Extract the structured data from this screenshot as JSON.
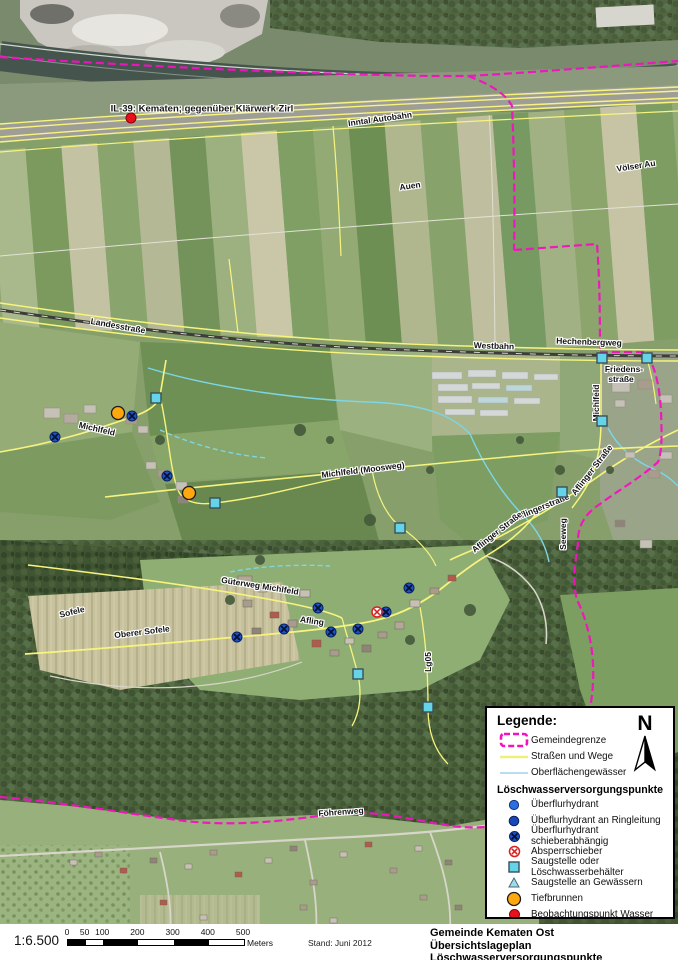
{
  "map": {
    "labels": [
      {
        "text": "IL-39: Kematen; gegenüber Klärwerk Zirl",
        "x": 202,
        "y": 109,
        "rot": 0,
        "cls": "callout"
      },
      {
        "text": "Inntal Autobahn",
        "x": 380,
        "y": 119,
        "rot": -8
      },
      {
        "text": "Auen",
        "x": 410,
        "y": 186,
        "rot": -8
      },
      {
        "text": "Völser Au",
        "x": 636,
        "y": 166,
        "rot": -9
      },
      {
        "text": "Landesstraße",
        "x": 118,
        "y": 326,
        "rot": 10
      },
      {
        "text": "Westbahn",
        "x": 494,
        "y": 346,
        "rot": 2
      },
      {
        "text": "Hechenbergweg",
        "x": 589,
        "y": 342,
        "rot": 2
      },
      {
        "text": "Friedens-",
        "x": 624,
        "y": 369,
        "rot": 0
      },
      {
        "text": "straße",
        "x": 621,
        "y": 379,
        "rot": 0
      },
      {
        "text": "Michlfeld",
        "x": 596,
        "y": 403,
        "rot": -90
      },
      {
        "text": "Michlfeld",
        "x": 97,
        "y": 429,
        "rot": 13
      },
      {
        "text": "Michlfeld (Moosweg)",
        "x": 363,
        "y": 470,
        "rot": -7
      },
      {
        "text": "Aflinger Straße",
        "x": 592,
        "y": 470,
        "rot": -52
      },
      {
        "text": "Aflingerstraße",
        "x": 542,
        "y": 507,
        "rot": -22
      },
      {
        "text": "Aflinger Straße",
        "x": 497,
        "y": 532,
        "rot": -38
      },
      {
        "text": "Seeweg",
        "x": 563,
        "y": 534,
        "rot": -90
      },
      {
        "text": "Güterweg Michlfeld",
        "x": 260,
        "y": 586,
        "rot": 9
      },
      {
        "text": "Afling",
        "x": 312,
        "y": 621,
        "rot": 8
      },
      {
        "text": "Sofele",
        "x": 72,
        "y": 612,
        "rot": -14
      },
      {
        "text": "Oberer Sofele",
        "x": 142,
        "y": 632,
        "rot": -7
      },
      {
        "text": "Lg05",
        "x": 428,
        "y": 662,
        "rot": -90
      },
      {
        "text": "Föhrenweg",
        "x": 341,
        "y": 812,
        "rot": -4
      }
    ],
    "symbols": [
      {
        "type": "obs",
        "x": 131,
        "y": 118
      },
      {
        "type": "well",
        "x": 118,
        "y": 413
      },
      {
        "type": "well",
        "x": 189,
        "y": 493
      },
      {
        "type": "hydrant-valve",
        "x": 55,
        "y": 437
      },
      {
        "type": "hydrant-valve",
        "x": 132,
        "y": 416
      },
      {
        "type": "hydrant-valve",
        "x": 167,
        "y": 476
      },
      {
        "type": "hydrant-valve",
        "x": 237,
        "y": 637
      },
      {
        "type": "hydrant-valve",
        "x": 284,
        "y": 629
      },
      {
        "type": "hydrant-valve",
        "x": 318,
        "y": 608
      },
      {
        "type": "hydrant-valve",
        "x": 331,
        "y": 632
      },
      {
        "type": "hydrant-valve",
        "x": 358,
        "y": 629
      },
      {
        "type": "hydrant-valve",
        "x": 386,
        "y": 612
      },
      {
        "type": "hydrant-valve",
        "x": 409,
        "y": 588
      },
      {
        "type": "valve",
        "x": 377,
        "y": 612
      },
      {
        "type": "suction",
        "x": 156,
        "y": 398
      },
      {
        "type": "suction",
        "x": 215,
        "y": 503
      },
      {
        "type": "suction",
        "x": 400,
        "y": 528
      },
      {
        "type": "suction",
        "x": 562,
        "y": 492
      },
      {
        "type": "suction",
        "x": 602,
        "y": 358
      },
      {
        "type": "suction",
        "x": 647,
        "y": 358
      },
      {
        "type": "suction",
        "x": 602,
        "y": 421
      },
      {
        "type": "suction",
        "x": 358,
        "y": 674
      },
      {
        "type": "suction",
        "x": 428,
        "y": 707
      }
    ]
  },
  "legend": {
    "title": "Legende:",
    "north_label": "N",
    "line_items": [
      {
        "symbol": "boundary-swatch",
        "label": "Gemeindegrenze"
      },
      {
        "symbol": "road-swatch",
        "label": "Straßen und Wege"
      },
      {
        "symbol": "water-swatch",
        "label": "Oberflächengewässer"
      }
    ],
    "points_header": "Löschwasserversorgungspunkte",
    "point_items": [
      {
        "symbol": "hydrant",
        "label": "Überflurhydrant"
      },
      {
        "symbol": "hydrant-ring",
        "label": "Übeflurhydrant an Ringleitung"
      },
      {
        "symbol": "hydrant-valve",
        "label": "Überflurhydrant schieberabhängig"
      },
      {
        "symbol": "valve",
        "label": "Absperrschieber"
      },
      {
        "symbol": "suction",
        "label": "Saugstelle oder Löschwasserbehälter"
      },
      {
        "symbol": "suction-tri",
        "label": "Saugstelle an Gewässern"
      },
      {
        "symbol": "well",
        "label": "Tiefbrunnen"
      },
      {
        "symbol": "obs",
        "label": "Beobachtungspunkt Wasser"
      }
    ]
  },
  "footer": {
    "scale_text": "1:6.500",
    "ticks": [
      0,
      50,
      100,
      200,
      300,
      400,
      500
    ],
    "unit": "Meters",
    "stand": "Stand: Juni 2012",
    "title1": "Gemeinde Kematen Ost",
    "title2": "Übersichtslageplan Löschwasserversorgungspunkte"
  },
  "colors": {
    "boundary": "#f312c0",
    "road": "#f7f47e",
    "water": "#7cd6e6",
    "hydrant_blue": "#1d52c4",
    "well_orange": "#ffa70f",
    "obs_red": "#e8101c"
  }
}
